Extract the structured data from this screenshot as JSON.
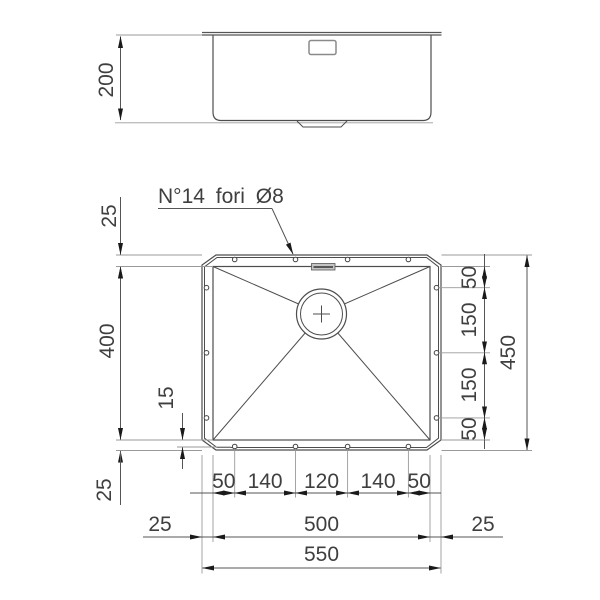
{
  "drawing": {
    "note": "N°14 fori Ø8",
    "side_view": {
      "depth": "200"
    },
    "plan": {
      "left": {
        "flange_top": "25",
        "bowl_height": "400",
        "hole_offset": "15",
        "flange_bottom": "25"
      },
      "right": {
        "chain": [
          "50",
          "150",
          "150",
          "50"
        ],
        "overall_height": "450"
      },
      "bottom": {
        "chain": [
          "50",
          "140",
          "120",
          "140",
          "50"
        ],
        "flange_left": "25",
        "bowl_width": "500",
        "flange_right": "25",
        "overall_width": "550"
      }
    }
  },
  "colors": {
    "background": "#ffffff",
    "line": "#4d4d4d",
    "dim_line": "#555555",
    "extension_line": "#9a9a9a",
    "arrow": "#1a1a1a",
    "text": "#3f3f3f",
    "overflow_slot_fill": "#c4c4c4"
  }
}
